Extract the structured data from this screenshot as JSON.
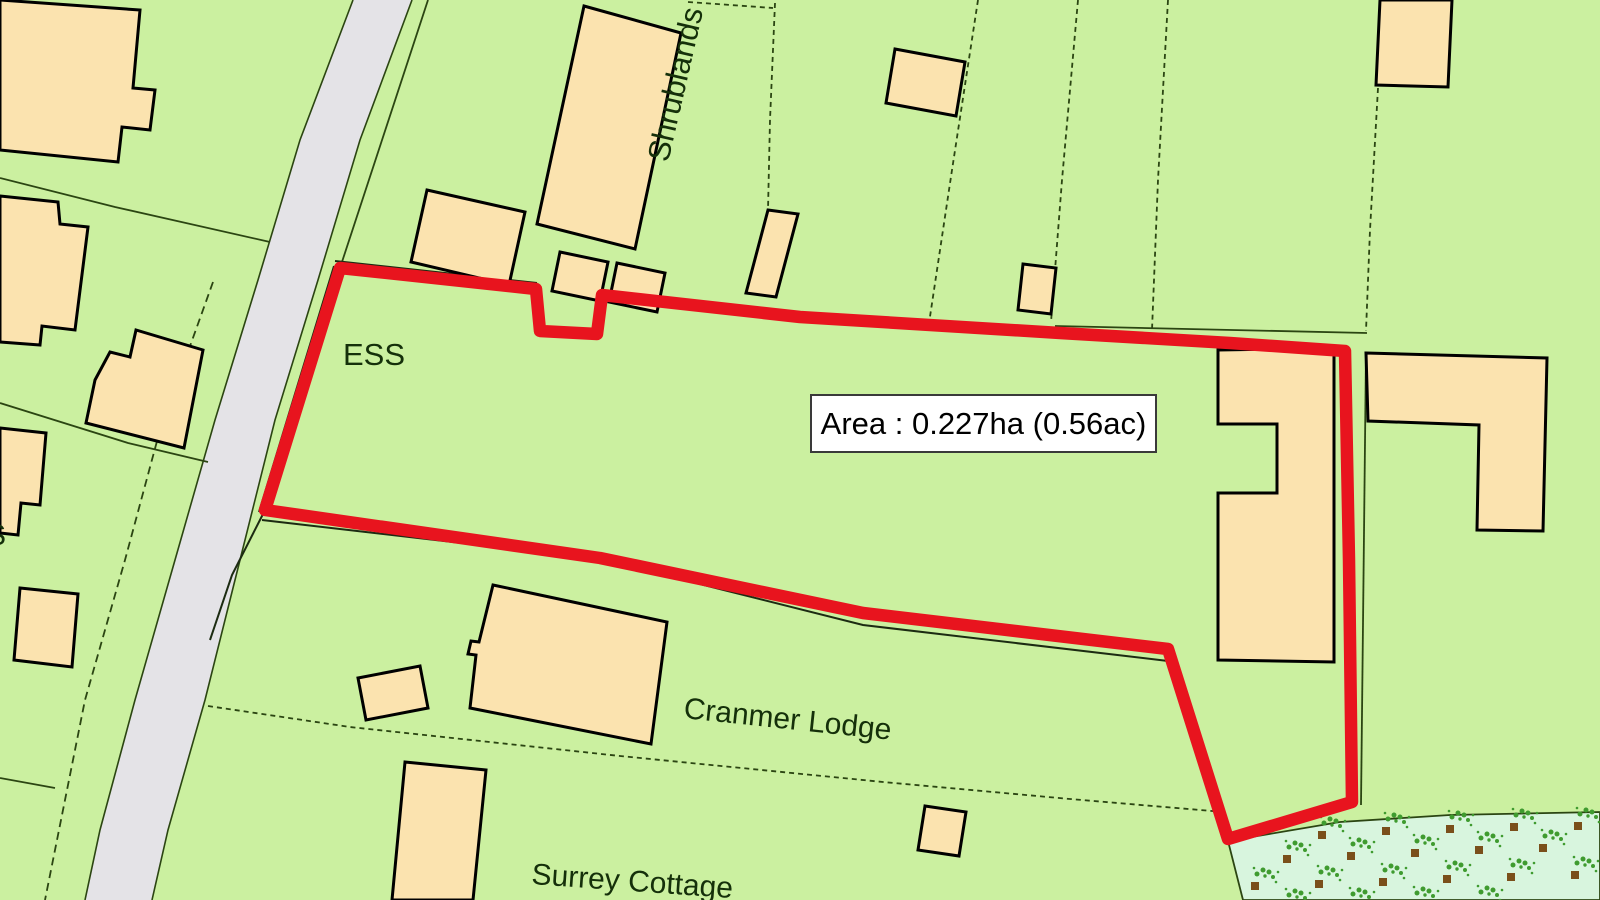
{
  "map": {
    "labels": {
      "shrublands": "Shrublands",
      "ess": "ESS",
      "cranmer_lodge": "Cranmer Lodge",
      "surrey_cottage": "Surrey Cottage",
      "edge_partial": "S"
    },
    "area_box": {
      "text": "Area : 0.227ha (0.56ac)"
    },
    "colors": {
      "background_green": "#cbf0a0",
      "building_fill": "#fbe3af",
      "building_stroke": "#000000",
      "road_fill": "#e4e3e7",
      "boundary_red": "#e8141e",
      "parcel_line": "#2b4512",
      "orchard_fill": "#d8f5de",
      "scrub_green": "#3f9b2f",
      "scrub_brown": "#7a4f1a",
      "label_color": "#15300a"
    }
  }
}
